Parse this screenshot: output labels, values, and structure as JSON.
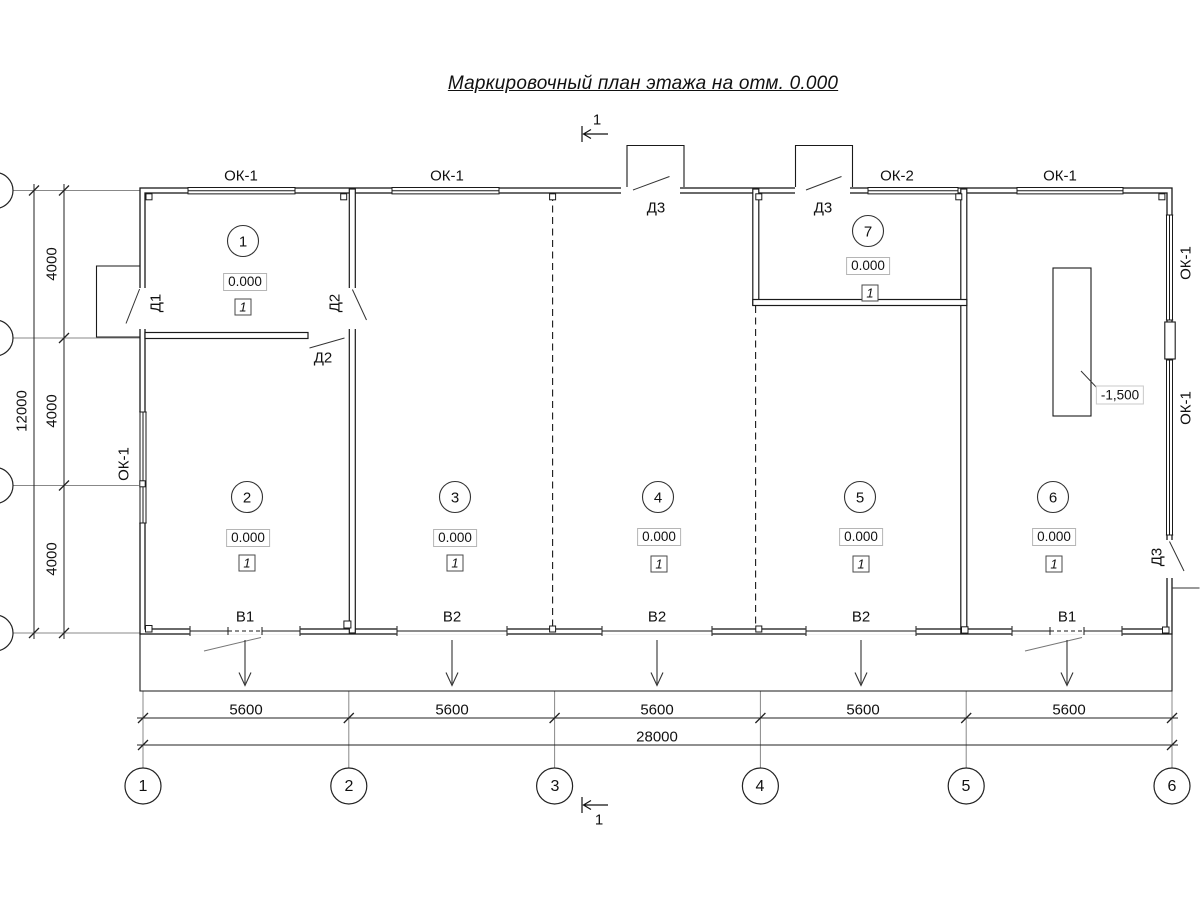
{
  "title": "Маркировочный план этажа на отм. 0.000",
  "section_marks": {
    "top": "1",
    "bottom": "1"
  },
  "axes_h": [
    "1",
    "2",
    "3",
    "4",
    "5",
    "6"
  ],
  "dims": {
    "bottom_spans": [
      "5600",
      "5600",
      "5600",
      "5600",
      "5600"
    ],
    "bottom_total": "28000",
    "left_spans": [
      "4000",
      "4000",
      "4000"
    ],
    "left_total": "12000"
  },
  "rooms": [
    {
      "number": "1",
      "elevation": "0.000",
      "finish_type": "1"
    },
    {
      "number": "2",
      "elevation": "0.000",
      "finish_type": "1"
    },
    {
      "number": "3",
      "elevation": "0.000",
      "finish_type": "1"
    },
    {
      "number": "4",
      "elevation": "0.000",
      "finish_type": "1"
    },
    {
      "number": "5",
      "elevation": "0.000",
      "finish_type": "1"
    },
    {
      "number": "6",
      "elevation": "0.000",
      "finish_type": "1"
    },
    {
      "number": "7",
      "elevation": "0.000",
      "finish_type": "1"
    }
  ],
  "openings": {
    "windows_top": [
      "ОК-1",
      "ОК-1",
      "ОК-2",
      "ОК-1"
    ],
    "window_left": "ОК-1",
    "windows_right": [
      "ОК-1",
      "ОК-1"
    ],
    "door_left": "Д1",
    "door_room1_side": "Д2",
    "door_room1_bottom": "Д2",
    "doors_top": [
      "Д3",
      "Д3"
    ],
    "door_right": "Д3",
    "gates": [
      "В1",
      "В2",
      "В2",
      "В2",
      "В1"
    ]
  },
  "pit": {
    "depth": "-1,500"
  },
  "colors": {
    "line": "#1a1a1a",
    "dim_line": "#222222",
    "ext_line": "#888888",
    "light_border": "#b5b5b5"
  }
}
